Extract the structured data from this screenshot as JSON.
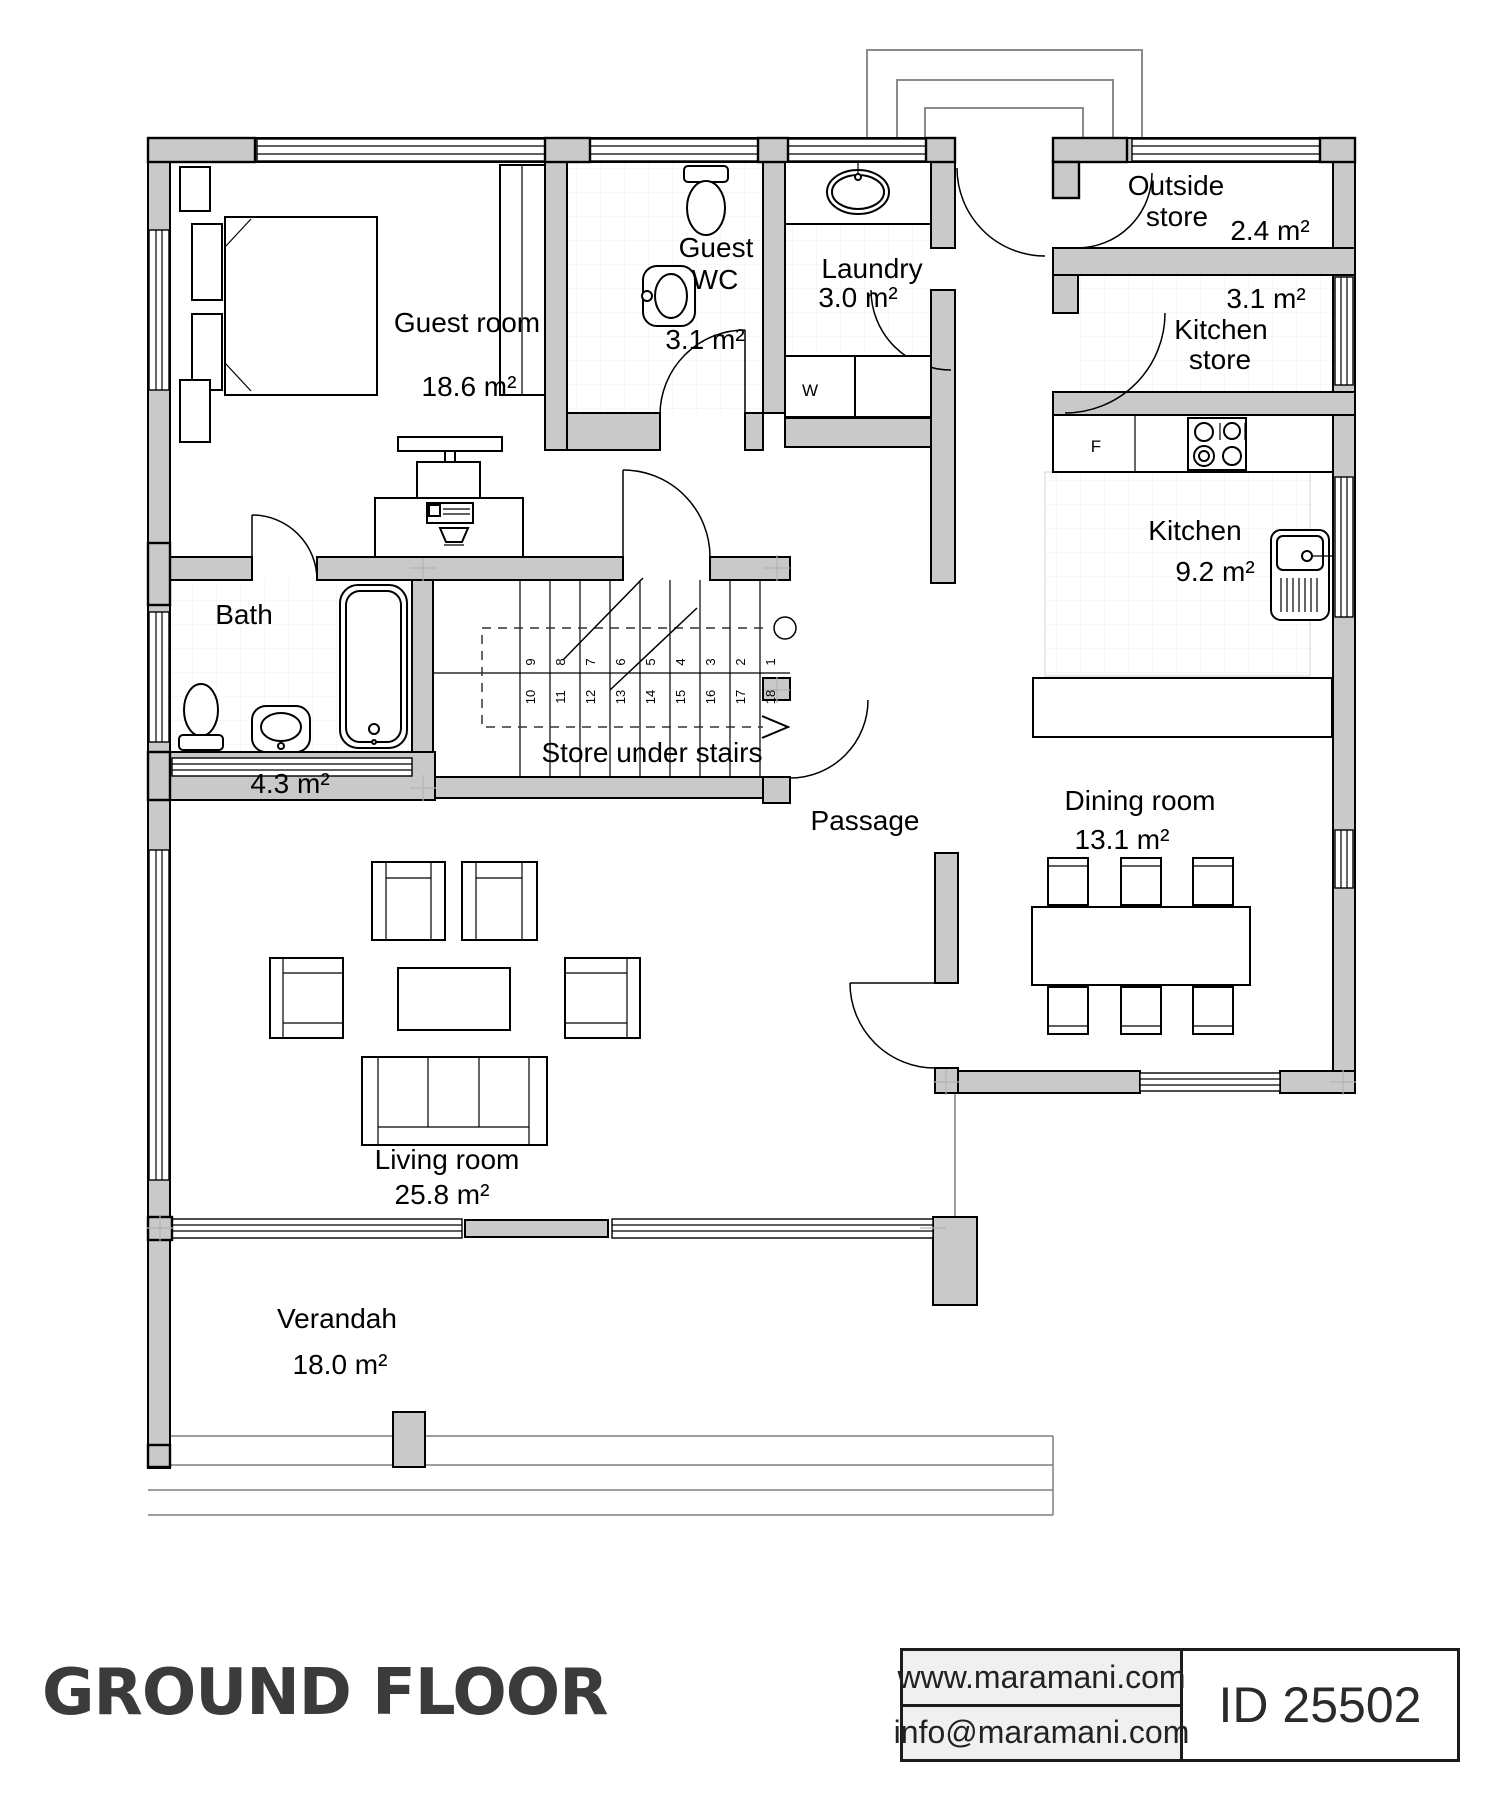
{
  "title": {
    "text": "GROUND FLOOR",
    "color": "#3b3b3b"
  },
  "footer": {
    "website": "www.maramani.com",
    "email": "info@maramani.com",
    "plan_id": "ID 25502"
  },
  "colors": {
    "wall_fill": "#c9c9c9",
    "outline": "#000000",
    "title_color": "#3b3b3b"
  },
  "rooms": {
    "guest_room": {
      "name": "Guest room",
      "area": "18.6 m²"
    },
    "guest_wc": {
      "line1": "Guest",
      "line2": "WC",
      "area": "3.1 m²"
    },
    "laundry": {
      "name": "Laundry",
      "area": "3.0 m²"
    },
    "outside_store": {
      "line1": "Outside",
      "line2": "store",
      "area": "2.4 m²"
    },
    "kitchen_store": {
      "area": "3.1 m²",
      "line1": "Kitchen",
      "line2": "store"
    },
    "kitchen": {
      "name": "Kitchen",
      "area": "9.2 m²"
    },
    "bath": {
      "name": "Bath",
      "area": "4.3 m²"
    },
    "store_under_stairs": {
      "name": "Store under stairs"
    },
    "passage": {
      "name": "Passage"
    },
    "dining_room": {
      "name": "Dining room",
      "area": "13.1 m²"
    },
    "living_room": {
      "name": "Living room",
      "area": "25.8 m²"
    },
    "verandah": {
      "name": "Verandah",
      "area": "18.0 m²"
    }
  },
  "fixtures": {
    "washing_machine": "W",
    "fridge": "F"
  },
  "stairs": {
    "numbers": [
      "1",
      "2",
      "3",
      "4",
      "5",
      "6",
      "7",
      "8",
      "9",
      "10",
      "11",
      "12",
      "13",
      "14",
      "15",
      "16",
      "17",
      "18"
    ]
  }
}
